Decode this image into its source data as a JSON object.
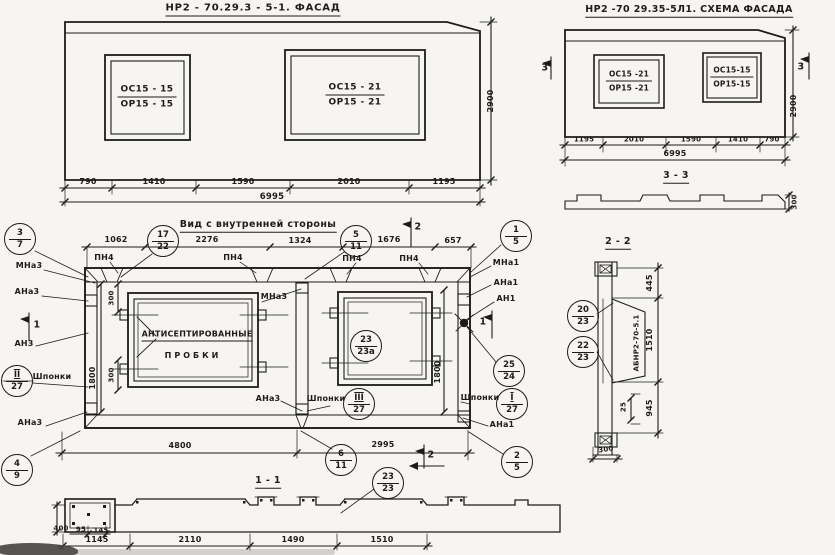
{
  "facade_left": {
    "title": "НР2 - 70.29.3   - 5-1. ФАСАД",
    "win1": {
      "top": "ОС15 - 15",
      "bot": "ОР15 - 15"
    },
    "win2": {
      "top": "ОС15 - 21",
      "bot": "ОР15 - 21"
    },
    "dims": [
      "790",
      "1410",
      "1590",
      "2010",
      "1195"
    ],
    "total": "6995",
    "height": "2900"
  },
  "facade_scheme": {
    "title": "НР2 -70 29.35-5Л1. СХЕМА ФАСАДА",
    "win1": {
      "top": "ОС15 -21",
      "bot": "ОР15 -21"
    },
    "win2": {
      "top": "ОС15-15",
      "bot": "ОР15-15"
    },
    "dims": [
      "1195",
      "2010",
      "1590",
      "1410",
      "790"
    ],
    "total": "6995",
    "height": "2900",
    "flag_left": "3",
    "flag_right": "3",
    "section": {
      "label": "3 - 3",
      "thickness": "300"
    }
  },
  "inner_view": {
    "title": "Вид с внутренней стороны",
    "dims_top": [
      "1062",
      "2276",
      "1324",
      "1676",
      "657"
    ],
    "pn4": "ПН4",
    "plug": {
      "line1": "АНТИСЕПТИРОВАННЫЕ",
      "line2": "ПРОБКИ"
    },
    "shponki": "Шпонки",
    "labels": {
      "mna3": "МНа3",
      "ana3": "АНа3",
      "an3": "АН3",
      "mna1": "МНа1",
      "ana1": "АНа1",
      "an1": "АН1"
    },
    "dim_300": "300",
    "dim_1800": "1800",
    "dims_bottom": [
      "4800",
      "2995"
    ],
    "flags": {
      "top": "2",
      "bottom": "2",
      "left": "1",
      "right": "1"
    },
    "callouts": {
      "c3_7": {
        "top": "3",
        "bot": "7"
      },
      "c17_22": {
        "top": "17",
        "bot": "22"
      },
      "c5_11": {
        "top": "5",
        "bot": "11"
      },
      "c1_5": {
        "top": "1",
        "bot": "5"
      },
      "c23_23a": {
        "top": "23",
        "bot": "23а"
      },
      "cII_27": {
        "top": "II",
        "bot": "27"
      },
      "cIII_27": {
        "top": "III",
        "bot": "27"
      },
      "cI_27": {
        "top": "I",
        "bot": "27"
      },
      "c25_24": {
        "top": "25",
        "bot": "24"
      },
      "c4_9": {
        "top": "4",
        "bot": "9"
      },
      "c6_11": {
        "top": "6",
        "bot": "11"
      },
      "c23_23": {
        "top": "23",
        "bot": "23"
      },
      "c2_5": {
        "top": "2",
        "bot": "5"
      }
    }
  },
  "section_1_1": {
    "label": "1 - 1",
    "dim_400": "400",
    "dim_95": "95",
    "dim_145": "145",
    "dims": [
      "1145",
      "2110",
      "1490",
      "1510"
    ]
  },
  "section_2_2": {
    "label": "2 - 2",
    "part_mark": "АБНР2-70-5.1",
    "dims": [
      "445",
      "1510",
      "945"
    ],
    "dim_25": "25",
    "dim_300": "300",
    "callouts": {
      "c20_23": {
        "top": "20",
        "bot": "23"
      },
      "c22_23": {
        "top": "22",
        "bot": "23"
      }
    }
  }
}
